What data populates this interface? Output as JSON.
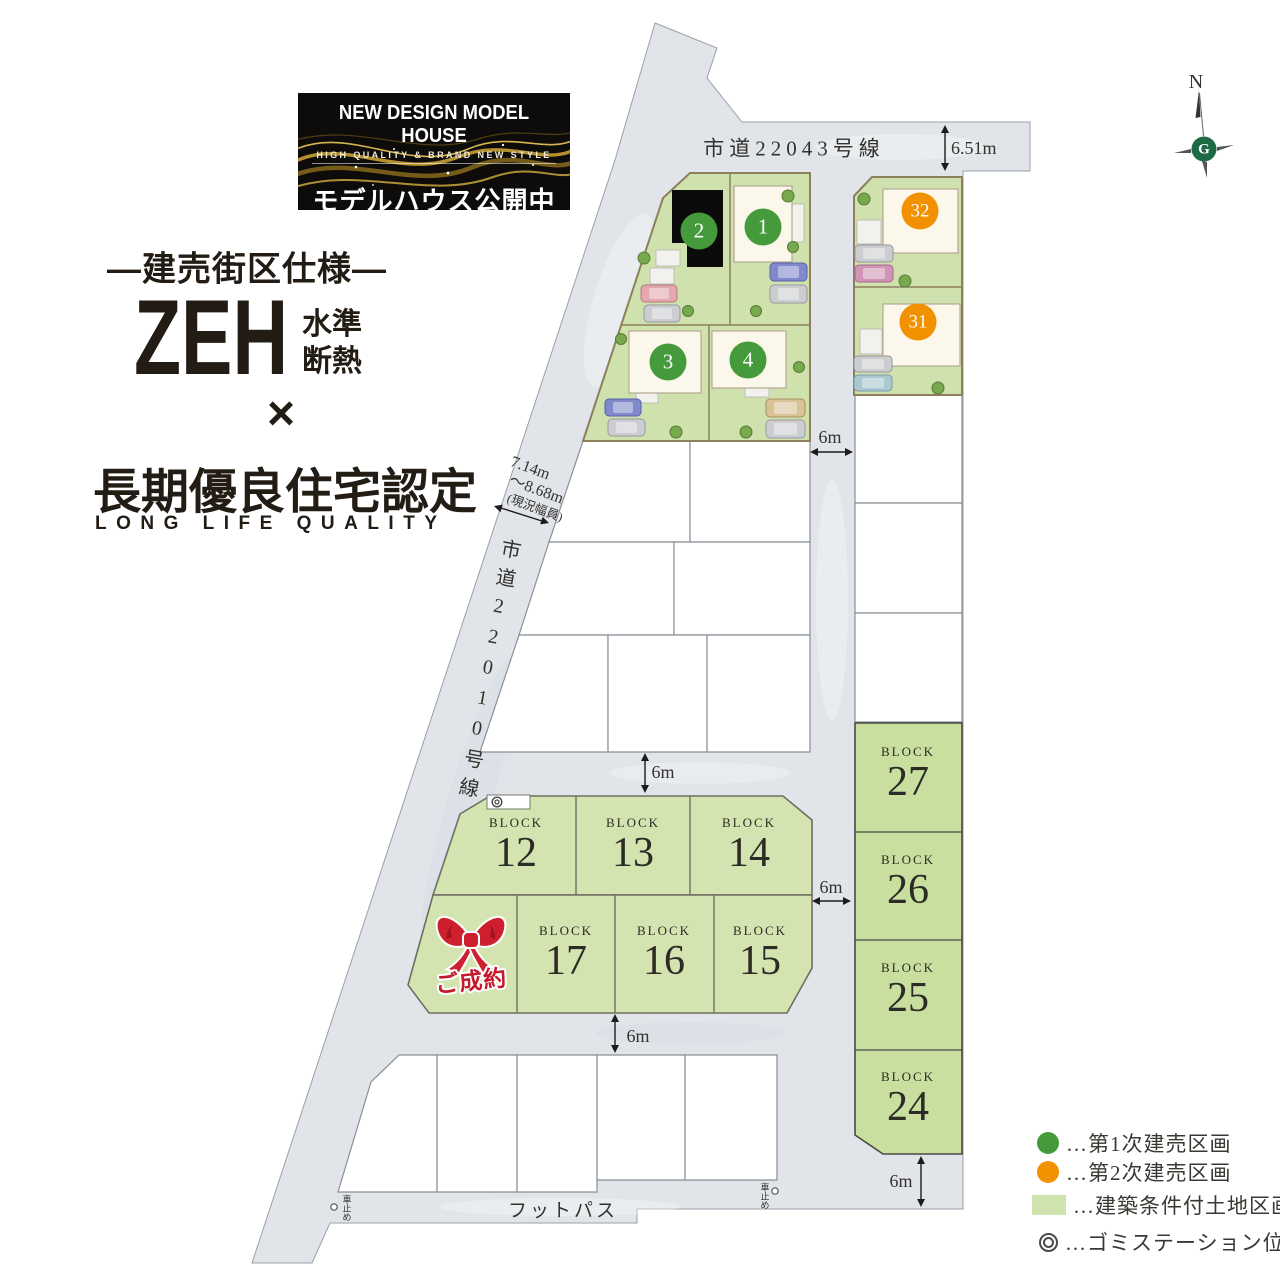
{
  "banner": {
    "title": "NEW DESIGN MODEL HOUSE",
    "subtitle": "HIGH QUALITY & BRAND NEW STYLE",
    "caption": "モデルハウス公開中"
  },
  "headline": {
    "spec": "―建売街区仕様―",
    "zeh": "ZEH",
    "zeh_top": "水準",
    "zeh_bottom": "断熱",
    "multiply": "×",
    "cert": "長期優良住宅認定",
    "cert_en": "LONG LIFE QUALITY"
  },
  "roads": {
    "top_name": "市道22043号線",
    "left_name": "市道22010号線",
    "footpath": "フットパス",
    "car_stop": "車止め"
  },
  "dims": {
    "top_width": "6.51m",
    "road_6m": "6m",
    "left_w1": "7.14m",
    "left_w2": "〜8.68m",
    "left_w3": "(現況幅員)"
  },
  "units": {
    "u1": "1",
    "u2": "2",
    "u3": "3",
    "u4": "4",
    "u31": "31",
    "u32": "32"
  },
  "blocks": {
    "word": "BLOCK",
    "n12": "12",
    "n13": "13",
    "n14": "14",
    "n15": "15",
    "n16": "16",
    "n17": "17",
    "n24": "24",
    "n25": "25",
    "n26": "26",
    "n27": "27"
  },
  "sold": {
    "label": "ご成約"
  },
  "compass": {
    "north": "N",
    "logo": "G"
  },
  "legend": {
    "items": [
      {
        "icon": "phase1-dot",
        "label": "…第1次建売区画"
      },
      {
        "icon": "phase2-dot",
        "label": "…第2次建売区画"
      },
      {
        "icon": "conditional-land-square",
        "label": "…建築条件付土地区画"
      },
      {
        "icon": "garbage-station-mark",
        "label": "…ゴミステーション位置"
      }
    ]
  },
  "colors": {
    "phase1_green": "#459a3c",
    "phase2_orange": "#f29100",
    "land_green": "#cfe2ae",
    "block_green": "#cbe0a4",
    "road_gray": "#e1e5ea",
    "sold_red": "#c41a2c",
    "model_house_black": "#0b0b0b"
  }
}
